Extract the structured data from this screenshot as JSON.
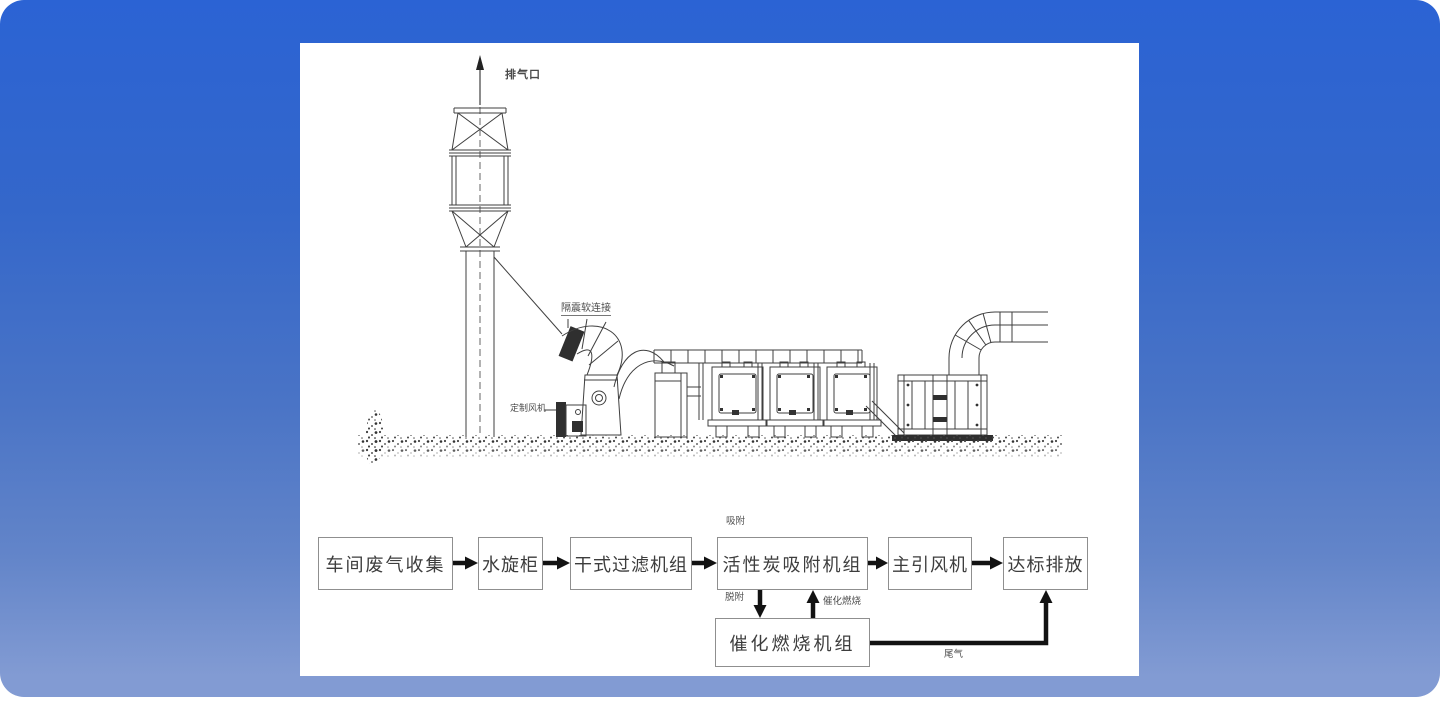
{
  "colors": {
    "background_top": "#2b63d4",
    "background_bottom": "#829bd3",
    "panel": "#ffffff",
    "drawing_line": "#3f3f3f",
    "arrow": "#121212",
    "box_border": "#8f8f8f",
    "box_text": "#3d3d3d"
  },
  "drawing": {
    "labels": {
      "exhaust_outlet": "排气口",
      "vibration_isolation_flexible_joint": "隔震软连接",
      "custom_fan": "定制风机"
    }
  },
  "flowchart": {
    "boxes": [
      {
        "label": "车间废气收集"
      },
      {
        "label": "水旋柜"
      },
      {
        "label": "干式过滤机组"
      },
      {
        "label": "活性炭吸附机组"
      },
      {
        "label": "主引风机"
      },
      {
        "label": "达标排放"
      },
      {
        "label": "催化燃烧机组"
      }
    ],
    "annotations": {
      "adsorption": "吸附",
      "desorption": "脱附",
      "catalytic_combustion": "催化燃烧",
      "tail_gas": "尾气"
    }
  }
}
